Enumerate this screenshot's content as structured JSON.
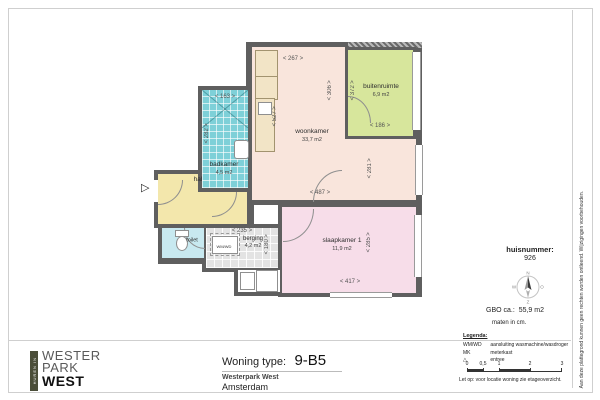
{
  "logo": {
    "vertical": "HUREN IN",
    "lines": [
      "WESTER",
      "PARK",
      "WEST"
    ]
  },
  "title_block": {
    "label": "Woning type:",
    "code": "9-B5",
    "project": "Westerpark West",
    "city": "Amsterdam"
  },
  "info_panel": {
    "huisnummer_label": "huisnummer:",
    "huisnummer_value": "926",
    "compass": {
      "n": "N",
      "e": "O",
      "s": "Z",
      "w": "W"
    },
    "gbo_label": "GBO ca.:",
    "gbo_value": "55,9 m2",
    "units_note": "maten in cm.",
    "legend_title": "Legenda:",
    "legend": [
      {
        "symbol": "WM/WD",
        "label": "aansluiting wasmachine/wasdroger"
      },
      {
        "symbol": "MK",
        "label": "meterkast"
      },
      {
        "symbol": "△",
        "label": "entree"
      }
    ],
    "scale_ticks": [
      "0",
      "0,5",
      "1",
      "2",
      "3"
    ],
    "note": "Let op:  voor locatie woning zie etageoverzicht."
  },
  "disclaimer": "Aan deze plattegrond kunnen geen rechten worden ontleend. Wijzigingen voorbehouden.",
  "plan": {
    "entree_symbol": "▷",
    "appliance_label": "WM/WD",
    "rooms": [
      {
        "name": "woonkamer",
        "area": "33,7 m2",
        "color": "#f9e5dc"
      },
      {
        "name": "buitenruimte",
        "area": "6,9 m2",
        "color": "#d7e69c"
      },
      {
        "name": "badkamer",
        "area": "4,5 m2",
        "color": "#7ed0d8"
      },
      {
        "name": "hal",
        "area": "",
        "color": "#f3e7ac"
      },
      {
        "name": "toilet",
        "area": "",
        "color": "#c8e9f0"
      },
      {
        "name": "berging",
        "area": "4,2 m2",
        "color": "#e3e3e3"
      },
      {
        "name": "slaapkamer 1",
        "area": "11,9 m2",
        "color": "#f7dde9"
      }
    ],
    "dims": {
      "woonkamer_top": "267",
      "woonkamer_left": "527",
      "woonkamer_right_upper": "306",
      "woonkamer_right_lower": "281",
      "woonkamer_bottom": "487",
      "buitenruimte_left": "372",
      "buitenruimte_bottom": "186",
      "badkamer_top": "163",
      "badkamer_left": "282",
      "berging_top": "235",
      "berging_right": "180",
      "slaapkamer_bottom": "417",
      "slaapkamer_right": "285"
    }
  },
  "colors": {
    "wall": "#5f5f5f",
    "logo_strip": "#4b4e39"
  }
}
